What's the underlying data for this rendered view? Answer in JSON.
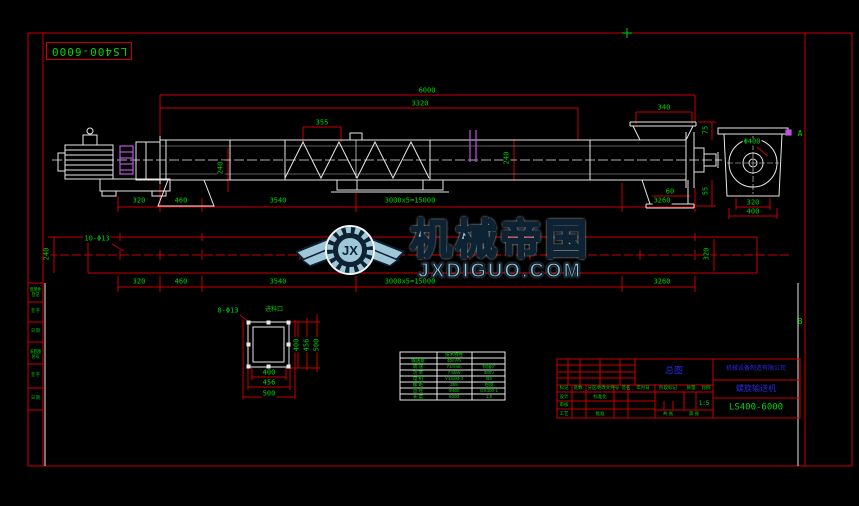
{
  "colors": {
    "line_red": "#c80000",
    "geometry_white": "#e8e8e8",
    "text_green": "#00d400",
    "accent_magenta": "#bb55e0",
    "text_blue": "#2a2ae0",
    "watermark_fill": "#9fc7d8",
    "watermark_outline": "#0d2233"
  },
  "sheet": {
    "code_box": "LS400-6000",
    "zone_a": "A",
    "zone_b": "B",
    "strip_cells": [
      "借用件登记",
      "签 字",
      "日 期",
      "旧底图总号",
      "签 字",
      "日 期"
    ]
  },
  "watermark": {
    "initials": "JX",
    "brand": "机械帝国",
    "site": "JXDIGUO.COM"
  },
  "side_view": {
    "dim_total": "6000",
    "dim_3320": "3320",
    "dim_340": "340",
    "dim_355": "355",
    "dim_240_mid": "240",
    "dim_240_left": "240",
    "dim_60": "60",
    "dim_75": "75",
    "dim_55": "55",
    "bottom_dims": [
      "320",
      "460",
      "3540",
      "3000x5=15000",
      "3260"
    ]
  },
  "end_view": {
    "dia_label": "Φ400",
    "dim_320": "320",
    "dim_400": "400"
  },
  "plan_view": {
    "holes_label": "10-Φ13",
    "dim_240": "240",
    "dim_320": "320",
    "bottom_dims": [
      "320",
      "460",
      "3540",
      "3000x5=15000",
      "3260"
    ]
  },
  "inlet_detail": {
    "holes_label": "8-Φ13",
    "title": "进料口",
    "dims_h": [
      "400",
      "456",
      "500"
    ],
    "dims_v": [
      "400",
      "456",
      "500"
    ]
  },
  "tech_table": {
    "rows": [
      {
        "c1": "",
        "c2": "技术特性",
        "c3": ""
      },
      {
        "c1": "输送量",
        "c2": "40m³/h",
        "c3": ""
      },
      {
        "c1": "转 速",
        "c2": "71r/min",
        "c3": "倾角0°"
      },
      {
        "c1": "功 率",
        "c2": "7.5kW",
        "c3": "380V"
      },
      {
        "c1": "电 机",
        "c2": "Y132M-4",
        "c3": "B3"
      },
      {
        "c1": "螺 距",
        "c2": "355",
        "c3": "右旋"
      },
      {
        "c1": "直 径",
        "c2": "Φ400",
        "c3": "GX400-1"
      },
      {
        "c1": "长 度",
        "c2": "6000",
        "c3": "1:5"
      }
    ]
  },
  "title_block": {
    "doc_title": "总图",
    "company": "机械设备制造有限公司",
    "product": "螺旋输送机",
    "drawing_no": "LS400-6000",
    "scale_value": "1:5",
    "labels": {
      "mark": "标记",
      "qty": "处数",
      "zone": "分区",
      "doc": "更改文件号",
      "sign": "签名",
      "date": "年月日",
      "design": "设计",
      "standard": "标准化",
      "stage": "阶段标记",
      "weight": "质量",
      "ratio": "比例",
      "check": "审核",
      "process": "工艺",
      "approve": "批准",
      "sheets": "共 张",
      "sheet_no": "第 张"
    }
  }
}
